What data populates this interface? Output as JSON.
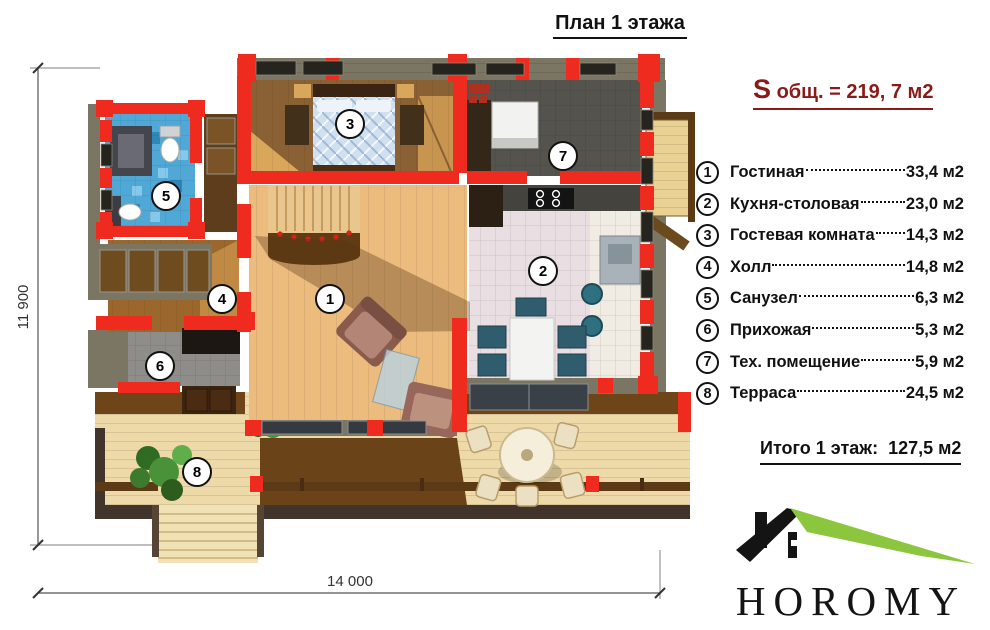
{
  "title": "План 1 этажа",
  "summary": {
    "s_symbol": "S",
    "rest": " общ. = 219, 7 м2"
  },
  "legend": {
    "items": [
      {
        "number": "1",
        "name": "Гостиная",
        "area": "33,4 м2"
      },
      {
        "number": "2",
        "name": "Кухня-столовая",
        "area": "23,0 м2"
      },
      {
        "number": "3",
        "name": "Гостевая комната",
        "area": "14,3 м2"
      },
      {
        "number": "4",
        "name": "Холл",
        "area": "14,8 м2"
      },
      {
        "number": "5",
        "name": "Санузел",
        "area": "6,3 м2"
      },
      {
        "number": "6",
        "name": "Прихожая",
        "area": "5,3 м2"
      },
      {
        "number": "7",
        "name": "Тех. помещение",
        "area": "5,9 м2"
      },
      {
        "number": "8",
        "name": "Терраса",
        "area": "24,5 м2"
      }
    ]
  },
  "total_label": "Итого 1 этаж:  127,5 м2",
  "logo": {
    "brand": "HOROMY"
  },
  "dimensions": {
    "height_label": "11 900",
    "width_label": "14 000"
  },
  "plan": {
    "markers": [
      {
        "number": "1"
      },
      {
        "number": "2"
      },
      {
        "number": "3"
      },
      {
        "number": "4"
      },
      {
        "number": "5"
      },
      {
        "number": "6"
      },
      {
        "number": "7"
      },
      {
        "number": "8"
      }
    ]
  },
  "palette": {
    "wall_red": "#ee2b1e",
    "log_wall": "#7b7664",
    "accent_maroon": "#8a1a18",
    "roof_green": "#8cc63e",
    "tile_blue": "#4fa8d6",
    "wood_light": "#ecbc7e",
    "terrace_cream": "#eedaa8"
  }
}
